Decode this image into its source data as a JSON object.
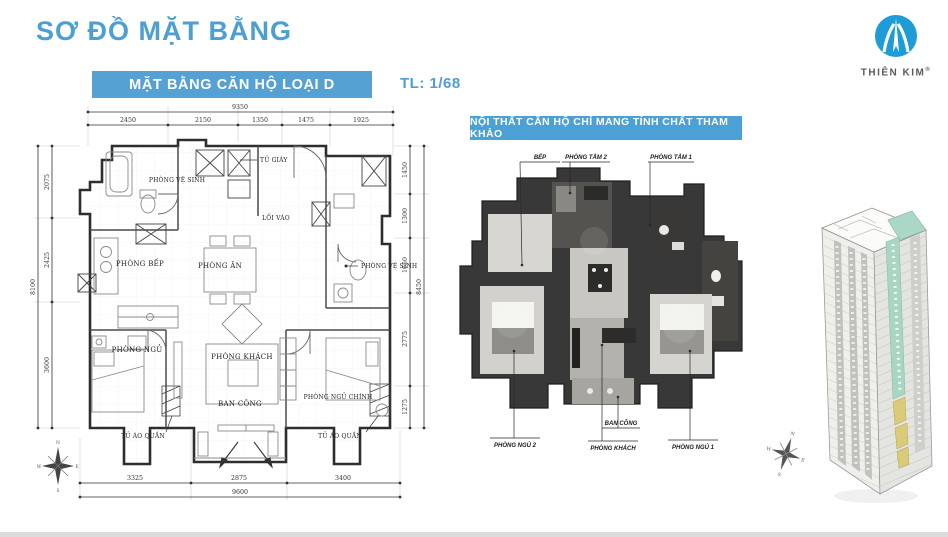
{
  "header": {
    "title": "SƠ ĐỒ MẶT BẰNG"
  },
  "brand": {
    "name": "THIÊN KIM",
    "reg": "®"
  },
  "plan_banner": {
    "label": "MẶT BẰNG CĂN HỘ LOẠI D",
    "scale": "TL: 1/68"
  },
  "colors": {
    "accent_blue": "#4b9fd3",
    "banner_blue": "#56a1d4",
    "logo_blue": "#1e9cd8",
    "teal_highlight": "#abd8c6",
    "yellow_highlight": "#d9cb78"
  },
  "plan2d": {
    "labels": {
      "shoe_cabinet": "TỦ GIÀY",
      "wc_top": "PHÒNG VỆ SINH",
      "entry": "LỐI VÀO",
      "kitchen": "PHÒNG BẾP",
      "dining": "PHÒNG ĂN",
      "wc_right": "PHÒNG VỆ SINH",
      "bedroom": "PHÒNG NGỦ",
      "living": "PHÒNG KHÁCH",
      "master_bedroom": "PHÒNG NGỦ CHÍNH",
      "balcony": "BAN CÔNG",
      "wardrobe_left": "TỦ ÁO QUẦN",
      "wardrobe_right": "TỦ ÁO QUẦN"
    },
    "dims": {
      "top": {
        "total": "9350",
        "segments": [
          "2450",
          "2150",
          "1350",
          "1475",
          "1925"
        ]
      },
      "bottom": {
        "total": "9600",
        "segments": [
          "3325",
          "2875",
          "3400"
        ]
      },
      "left": {
        "total": "8100",
        "segments": [
          "2075",
          "2425",
          "3600"
        ]
      },
      "right": {
        "total": "8450",
        "segments": [
          "1450",
          "1300",
          "1650",
          "2775",
          "1275"
        ]
      }
    }
  },
  "plan3d": {
    "banner": "NỘI THẤT CĂN HỘ CHỈ MANG TÍNH CHẤT THAM KHẢO",
    "labels": {
      "kitchen": "BẾP",
      "bath2": "PHÒNG TẮM 2",
      "bath1": "PHÒNG TẮM 1",
      "bedroom2": "PHÒNG NGỦ 2",
      "living": "PHÒNG KHÁCH",
      "balcony": "BAN CÔNG",
      "bedroom1": "PHÒNG NGỦ 1"
    }
  },
  "compass": {
    "n": "N",
    "e": "E",
    "s": "S",
    "w": "W"
  }
}
